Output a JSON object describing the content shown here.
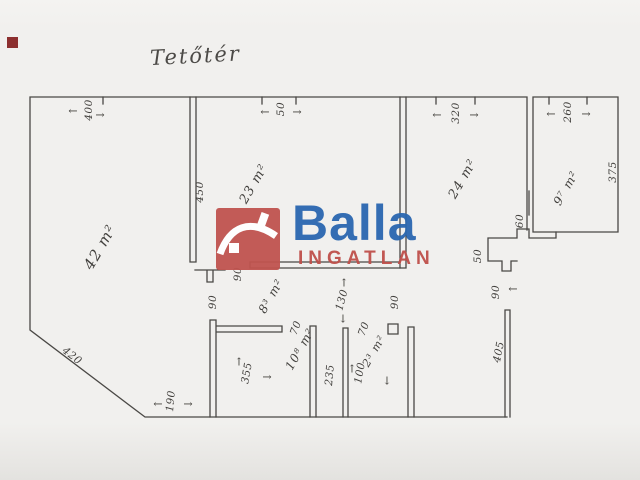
{
  "title": {
    "text": "Tetőtér"
  },
  "logo": {
    "brand": "Balla",
    "subtitle": "INGATLAN",
    "colors": {
      "box": "#c0544f",
      "brand": "#2a67b0",
      "subtitle": "#bf4f4a"
    }
  },
  "corner_mark_color": "#8c2f2f",
  "ink_color": "#45433f",
  "rooms": {
    "attic_left": {
      "label": "42 m²"
    },
    "attic_middle": {
      "label": "23 m²"
    },
    "attic_right": {
      "label": "24 m²"
    },
    "attic_top_right": {
      "label": "9⁷ m²"
    },
    "hall": {
      "label": "8³ m²"
    },
    "bottom_left": {
      "label": "10⁸ m²"
    },
    "bottom_middle": {
      "label": "2³ m²"
    }
  },
  "dimensions": {
    "top_left": {
      "text": "400"
    },
    "top_middle": {
      "text": "50"
    },
    "top_right": {
      "text": "320"
    },
    "top_far_right": {
      "text": "260"
    },
    "middle_left_wall": {
      "text": "450"
    },
    "far_right_wall": {
      "text": "375"
    },
    "right_wall_stub": {
      "text": "60"
    },
    "right_step": {
      "text": "50"
    },
    "hall_left_opening": {
      "text": "90"
    },
    "hall_left_lower": {
      "text": "90"
    },
    "hall_middle": {
      "text": "130"
    },
    "hall_right_opening": {
      "text": "90"
    },
    "right_door": {
      "text": "90"
    },
    "right_lower_wall": {
      "text": "405"
    },
    "bottom_left_width": {
      "text": "355"
    },
    "bottom_left_door": {
      "text": "70"
    },
    "bottom_left_height": {
      "text": "235"
    },
    "bottom_middle_door": {
      "text": "70"
    },
    "bottom_middle_width": {
      "text": "100"
    },
    "bottom_corner": {
      "text": "190"
    },
    "diagonal_wall": {
      "text": "420"
    }
  },
  "icons": {
    "arrow_left": "←",
    "arrow_right": "→",
    "arrow_up": "↑",
    "arrow_down": "↓"
  }
}
